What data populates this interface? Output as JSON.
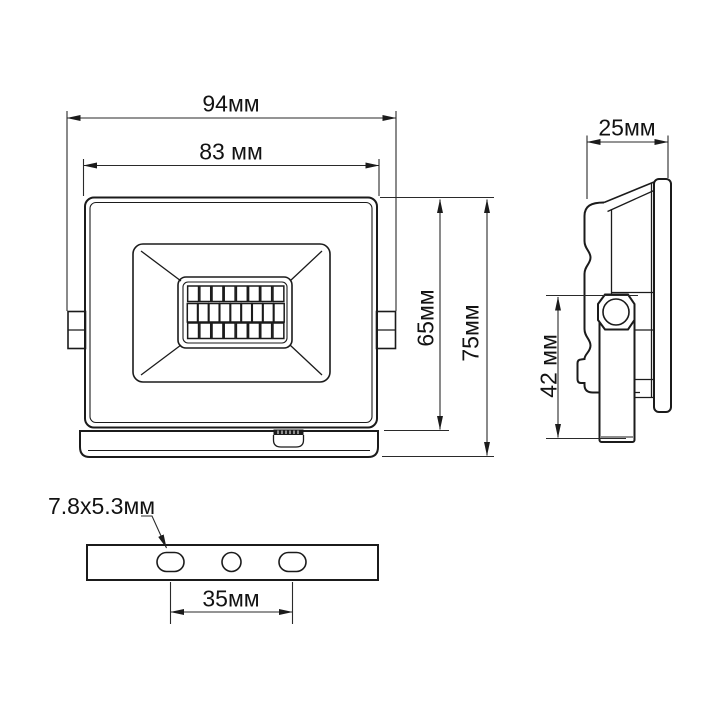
{
  "drawing": {
    "subject": "LED floodlight dimensional drawing",
    "units": "mm"
  },
  "front_view": {
    "overall_width": "94мм",
    "body_width": "83 мм",
    "body_height": "65мм",
    "overall_height": "75мм",
    "led_grid_rows": [
      8,
      9,
      8
    ]
  },
  "side_view": {
    "depth": "25мм",
    "bracket_length": "42 мм"
  },
  "bottom_view": {
    "slot_size": "7.8x5.3мм",
    "slot_spacing": "35мм"
  },
  "colors": {
    "line": "#1b1b1b",
    "dimension_line": "#2a2a2a",
    "background": "#ffffff"
  }
}
